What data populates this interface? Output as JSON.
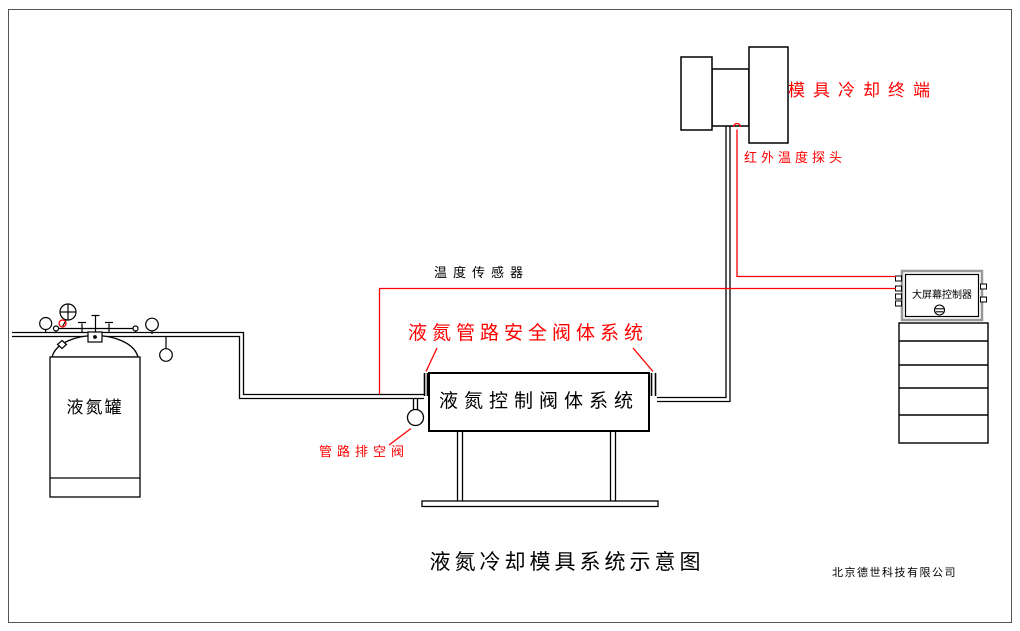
{
  "diagram": {
    "title": "液氮冷却模具系统示意图",
    "company": "北京德世科技有限公司",
    "labels": {
      "mold_terminal": "模具冷却终端",
      "ir_probe": "红外温度探头",
      "temp_sensor": "温度传感器",
      "safety_system": "液氮管路安全阀体系统",
      "control_box": "液氮控制阀体系统",
      "vent_valve": "管路排空阀",
      "tank": "液氮罐",
      "controller": "大屏幕控制器"
    },
    "colors": {
      "annotation_red": "#ff0000",
      "line_black": "#000000",
      "frame_gray": "#555555",
      "controller_frame_gray": "#999999"
    }
  }
}
